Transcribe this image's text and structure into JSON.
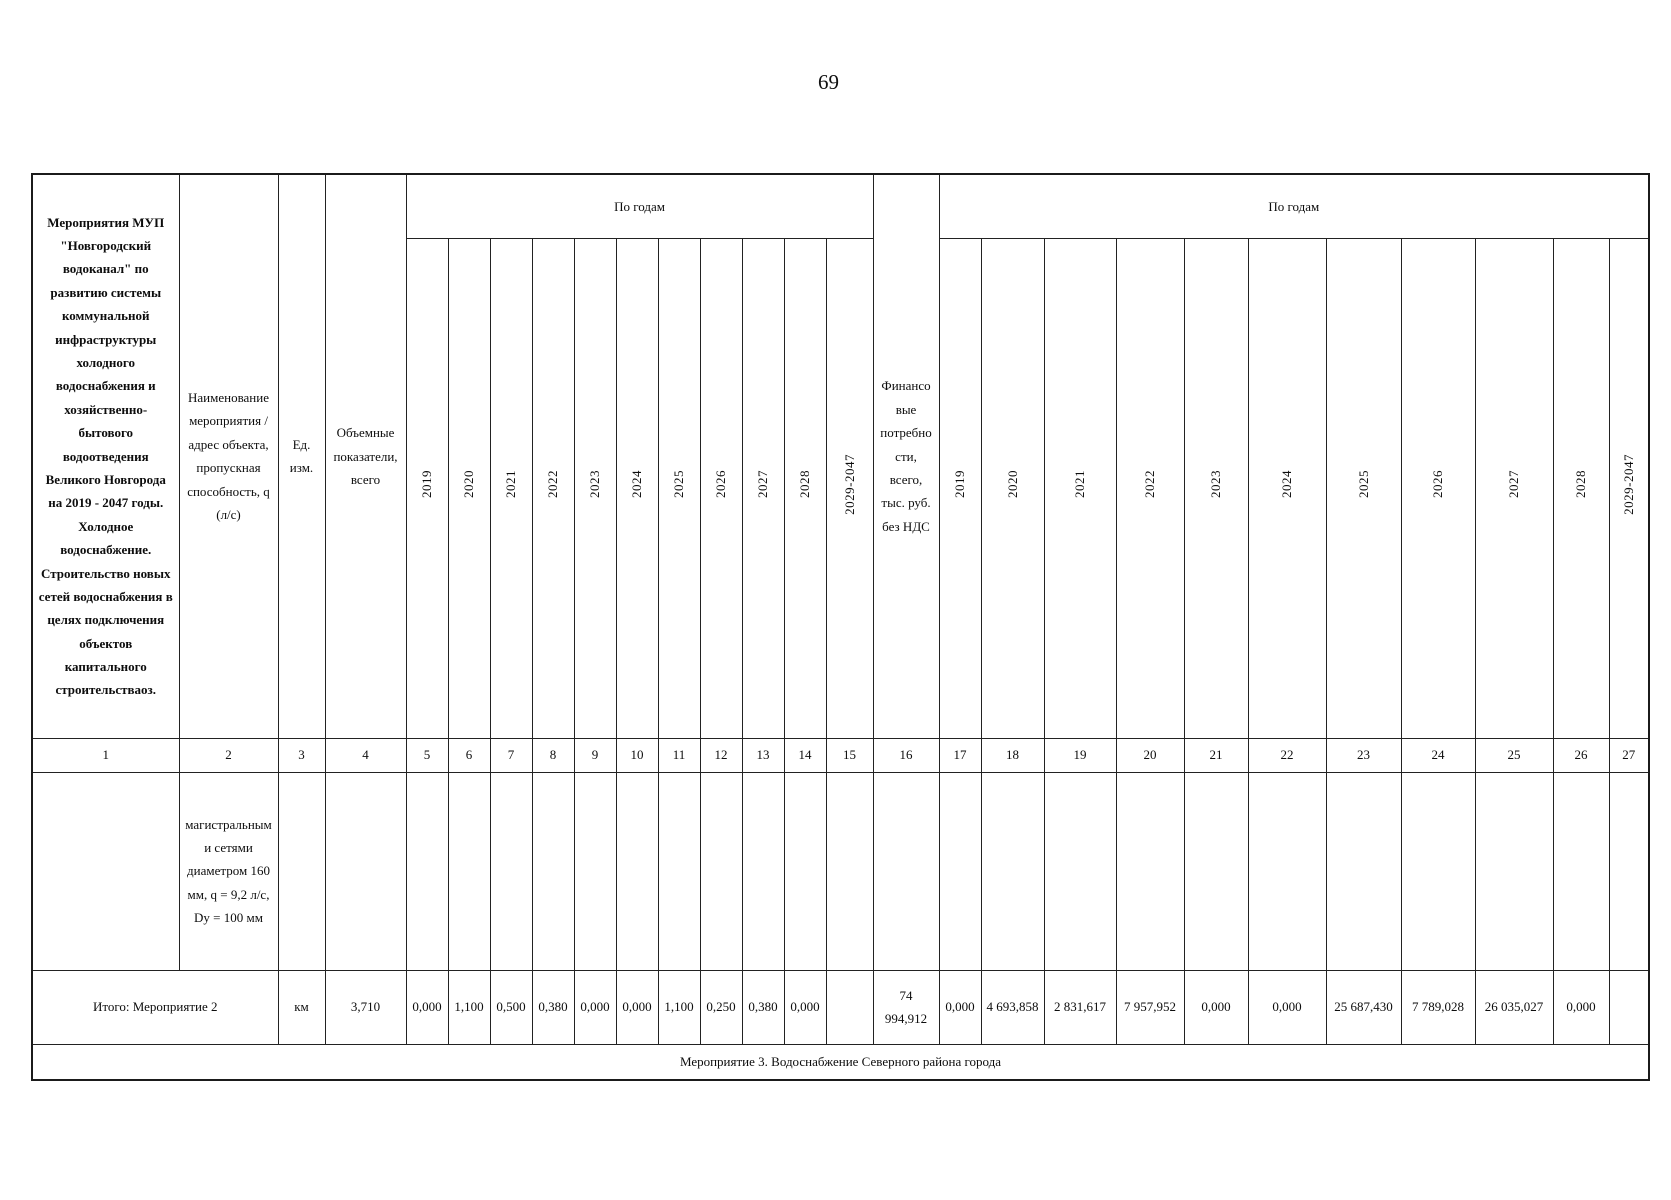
{
  "page": {
    "number": "69"
  },
  "table": {
    "header": {
      "program": "Мероприятия МУП \"Новгородский водоканал\" по развитию системы коммунальной инфраструктуры холодного водоснабжения и хозяйственно-бытового водоотведения Великого Новгорода на 2019 - 2047 годы. Холодное водоснабжение. Строительство новых сетей водоснабжения в целях подключения объектов капитального строительстваоз.",
      "measure_name": "Наименование мероприятия /адрес объекта, пропускная способность, q (л/с)",
      "unit": "Ед. изм.",
      "volume": "Объемные показатели, всего",
      "by_years": "По годам",
      "finance": "Финансовые потребности, всего, тыс. руб. без НДС",
      "years": [
        "2019",
        "2020",
        "2021",
        "2022",
        "2023",
        "2024",
        "2025",
        "2026",
        "2027",
        "2028",
        "2029-2047"
      ]
    },
    "column_numbers": [
      "1",
      "2",
      "3",
      "4",
      "5",
      "6",
      "7",
      "8",
      "9",
      "10",
      "11",
      "12",
      "13",
      "14",
      "15",
      "16",
      "17",
      "18",
      "19",
      "20",
      "21",
      "22",
      "23",
      "24",
      "25",
      "26",
      "27"
    ],
    "detail_row": {
      "measure": "магистральными сетями диаметром 160 мм,  q = 9,2 л/с, Dy = 100 мм"
    },
    "total_row": {
      "label": "Итого: Мероприятие 2",
      "unit": "км",
      "volume_total": "3,710",
      "volume_by_year": [
        "0,000",
        "1,100",
        "0,500",
        "0,380",
        "0,000",
        "0,000",
        "1,100",
        "0,250",
        "0,380",
        "0,000",
        ""
      ],
      "finance_total": "74 994,912",
      "finance_by_year": [
        "0,000",
        "4 693,858",
        "2 831,617",
        "7 957,952",
        "0,000",
        "0,000",
        "25 687,430",
        "7 789,028",
        "26 035,027",
        "0,000",
        ""
      ]
    },
    "section_row": {
      "label": "Мероприятие 3. Водоснабжение Северного района города"
    }
  }
}
